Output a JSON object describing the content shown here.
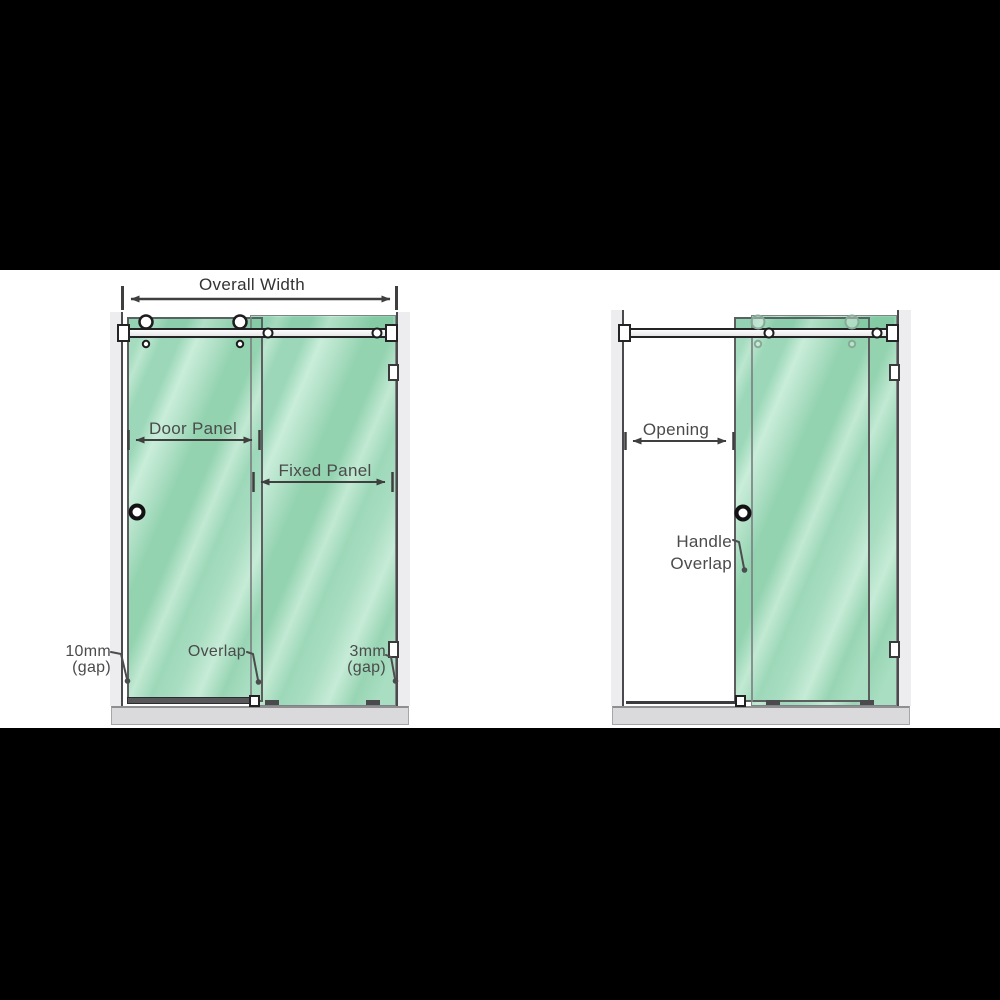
{
  "colors": {
    "background": "#ffffff",
    "letterbox_band": "#000000",
    "glass_green": "#a3dcbe",
    "glass_highlight": "#c8ecd8",
    "label_text": "#4b4b4b",
    "dimension_line": "#3f3f3f",
    "wall_fill": "#ededef",
    "tray_fill": "#dadadc",
    "hardware_outline": "#242426"
  },
  "left_diagram": {
    "overall_width_label": "Overall Width",
    "door_panel_label": "Door Panel",
    "fixed_panel_label": "Fixed Panel",
    "left_gap_value": "10mm",
    "left_gap_unit": "(gap)",
    "overlap_label": "Overlap",
    "right_gap_value": "3mm",
    "right_gap_unit": "(gap)"
  },
  "right_diagram": {
    "opening_label": "Opening",
    "handle_overlap_line1": "Handle",
    "handle_overlap_line2": "Overlap"
  }
}
